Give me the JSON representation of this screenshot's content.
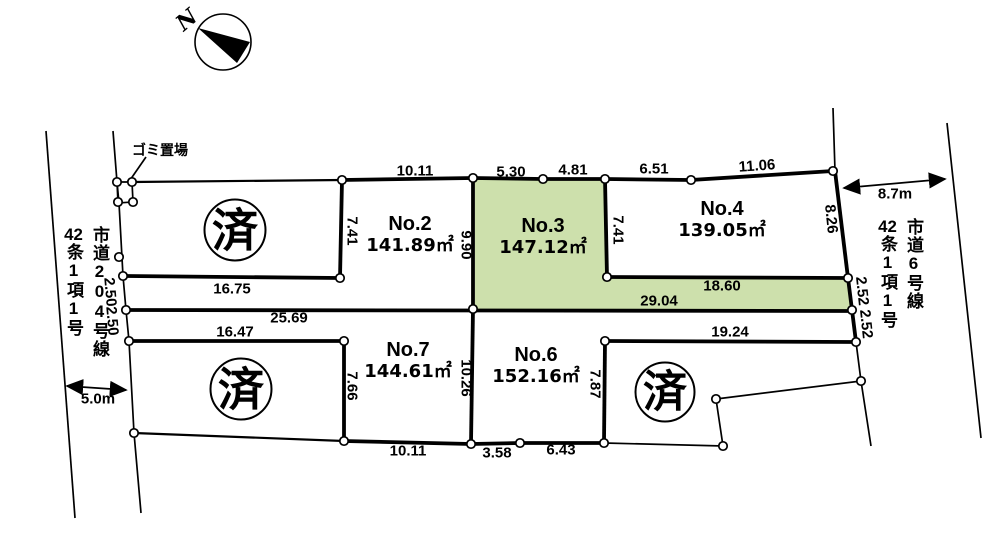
{
  "compass": {
    "north_label": "N"
  },
  "garbage_area": {
    "label": "ゴミ置場"
  },
  "stamps": {
    "label": "済"
  },
  "plots": [
    {
      "name": "No.2",
      "area": "141.89㎡",
      "highlighted": false
    },
    {
      "name": "No.3",
      "area": "147.12㎡",
      "highlighted": true
    },
    {
      "name": "No.4",
      "area": "139.05㎡",
      "highlighted": false
    },
    {
      "name": "No.6",
      "area": "152.16㎡",
      "highlighted": false
    },
    {
      "name": "No.7",
      "area": "144.61㎡",
      "highlighted": false
    }
  ],
  "roads": {
    "left": {
      "name": "市道204号線",
      "article_num": "42",
      "article_rest": "条1項1号",
      "width": "5.0m"
    },
    "right": {
      "name": "市道6号線",
      "article_num": "42",
      "article_rest": "条1項1号",
      "width": "8.7m"
    }
  },
  "dimensions": [
    {
      "text": "10.11",
      "x": 415,
      "y": 171,
      "rot": 0
    },
    {
      "text": "5.30",
      "x": 511,
      "y": 172,
      "rot": 0
    },
    {
      "text": "4.81",
      "x": 573,
      "y": 170,
      "rot": 0
    },
    {
      "text": "6.51",
      "x": 654,
      "y": 169,
      "rot": 0
    },
    {
      "text": "11.06",
      "x": 757,
      "y": 166,
      "rot": -4
    },
    {
      "text": "7.41",
      "x": 352,
      "y": 231,
      "rot": 90
    },
    {
      "text": "9.90",
      "x": 466,
      "y": 245,
      "rot": 90
    },
    {
      "text": "7.41",
      "x": 618,
      "y": 230,
      "rot": 90
    },
    {
      "text": "8.26",
      "x": 831,
      "y": 219,
      "rot": 84
    },
    {
      "text": "16.75",
      "x": 232,
      "y": 289,
      "rot": 0
    },
    {
      "text": "18.60",
      "x": 722,
      "y": 286,
      "rot": 0
    },
    {
      "text": "29.04",
      "x": 659,
      "y": 301,
      "rot": 0
    },
    {
      "text": "25.69",
      "x": 289,
      "y": 318,
      "rot": 0
    },
    {
      "text": "2.50",
      "x": 110,
      "y": 292,
      "rot": 85
    },
    {
      "text": "2.50",
      "x": 112,
      "y": 321,
      "rot": 85
    },
    {
      "text": "2.52",
      "x": 862,
      "y": 291,
      "rot": 84
    },
    {
      "text": "2.52",
      "x": 866,
      "y": 324,
      "rot": 84
    },
    {
      "text": "16.47",
      "x": 235,
      "y": 332,
      "rot": 0
    },
    {
      "text": "19.24",
      "x": 730,
      "y": 332,
      "rot": 0
    },
    {
      "text": "7.66",
      "x": 352,
      "y": 386,
      "rot": 90
    },
    {
      "text": "10.26",
      "x": 466,
      "y": 378,
      "rot": 90
    },
    {
      "text": "7.87",
      "x": 595,
      "y": 384,
      "rot": 90
    },
    {
      "text": "10.11",
      "x": 408,
      "y": 451,
      "rot": 0
    },
    {
      "text": "3.58",
      "x": 497,
      "y": 453,
      "rot": 0
    },
    {
      "text": "6.43",
      "x": 561,
      "y": 450,
      "rot": 0
    }
  ],
  "colors": {
    "highlight": "#cde0ac",
    "line": "#000000",
    "background": "#ffffff"
  }
}
